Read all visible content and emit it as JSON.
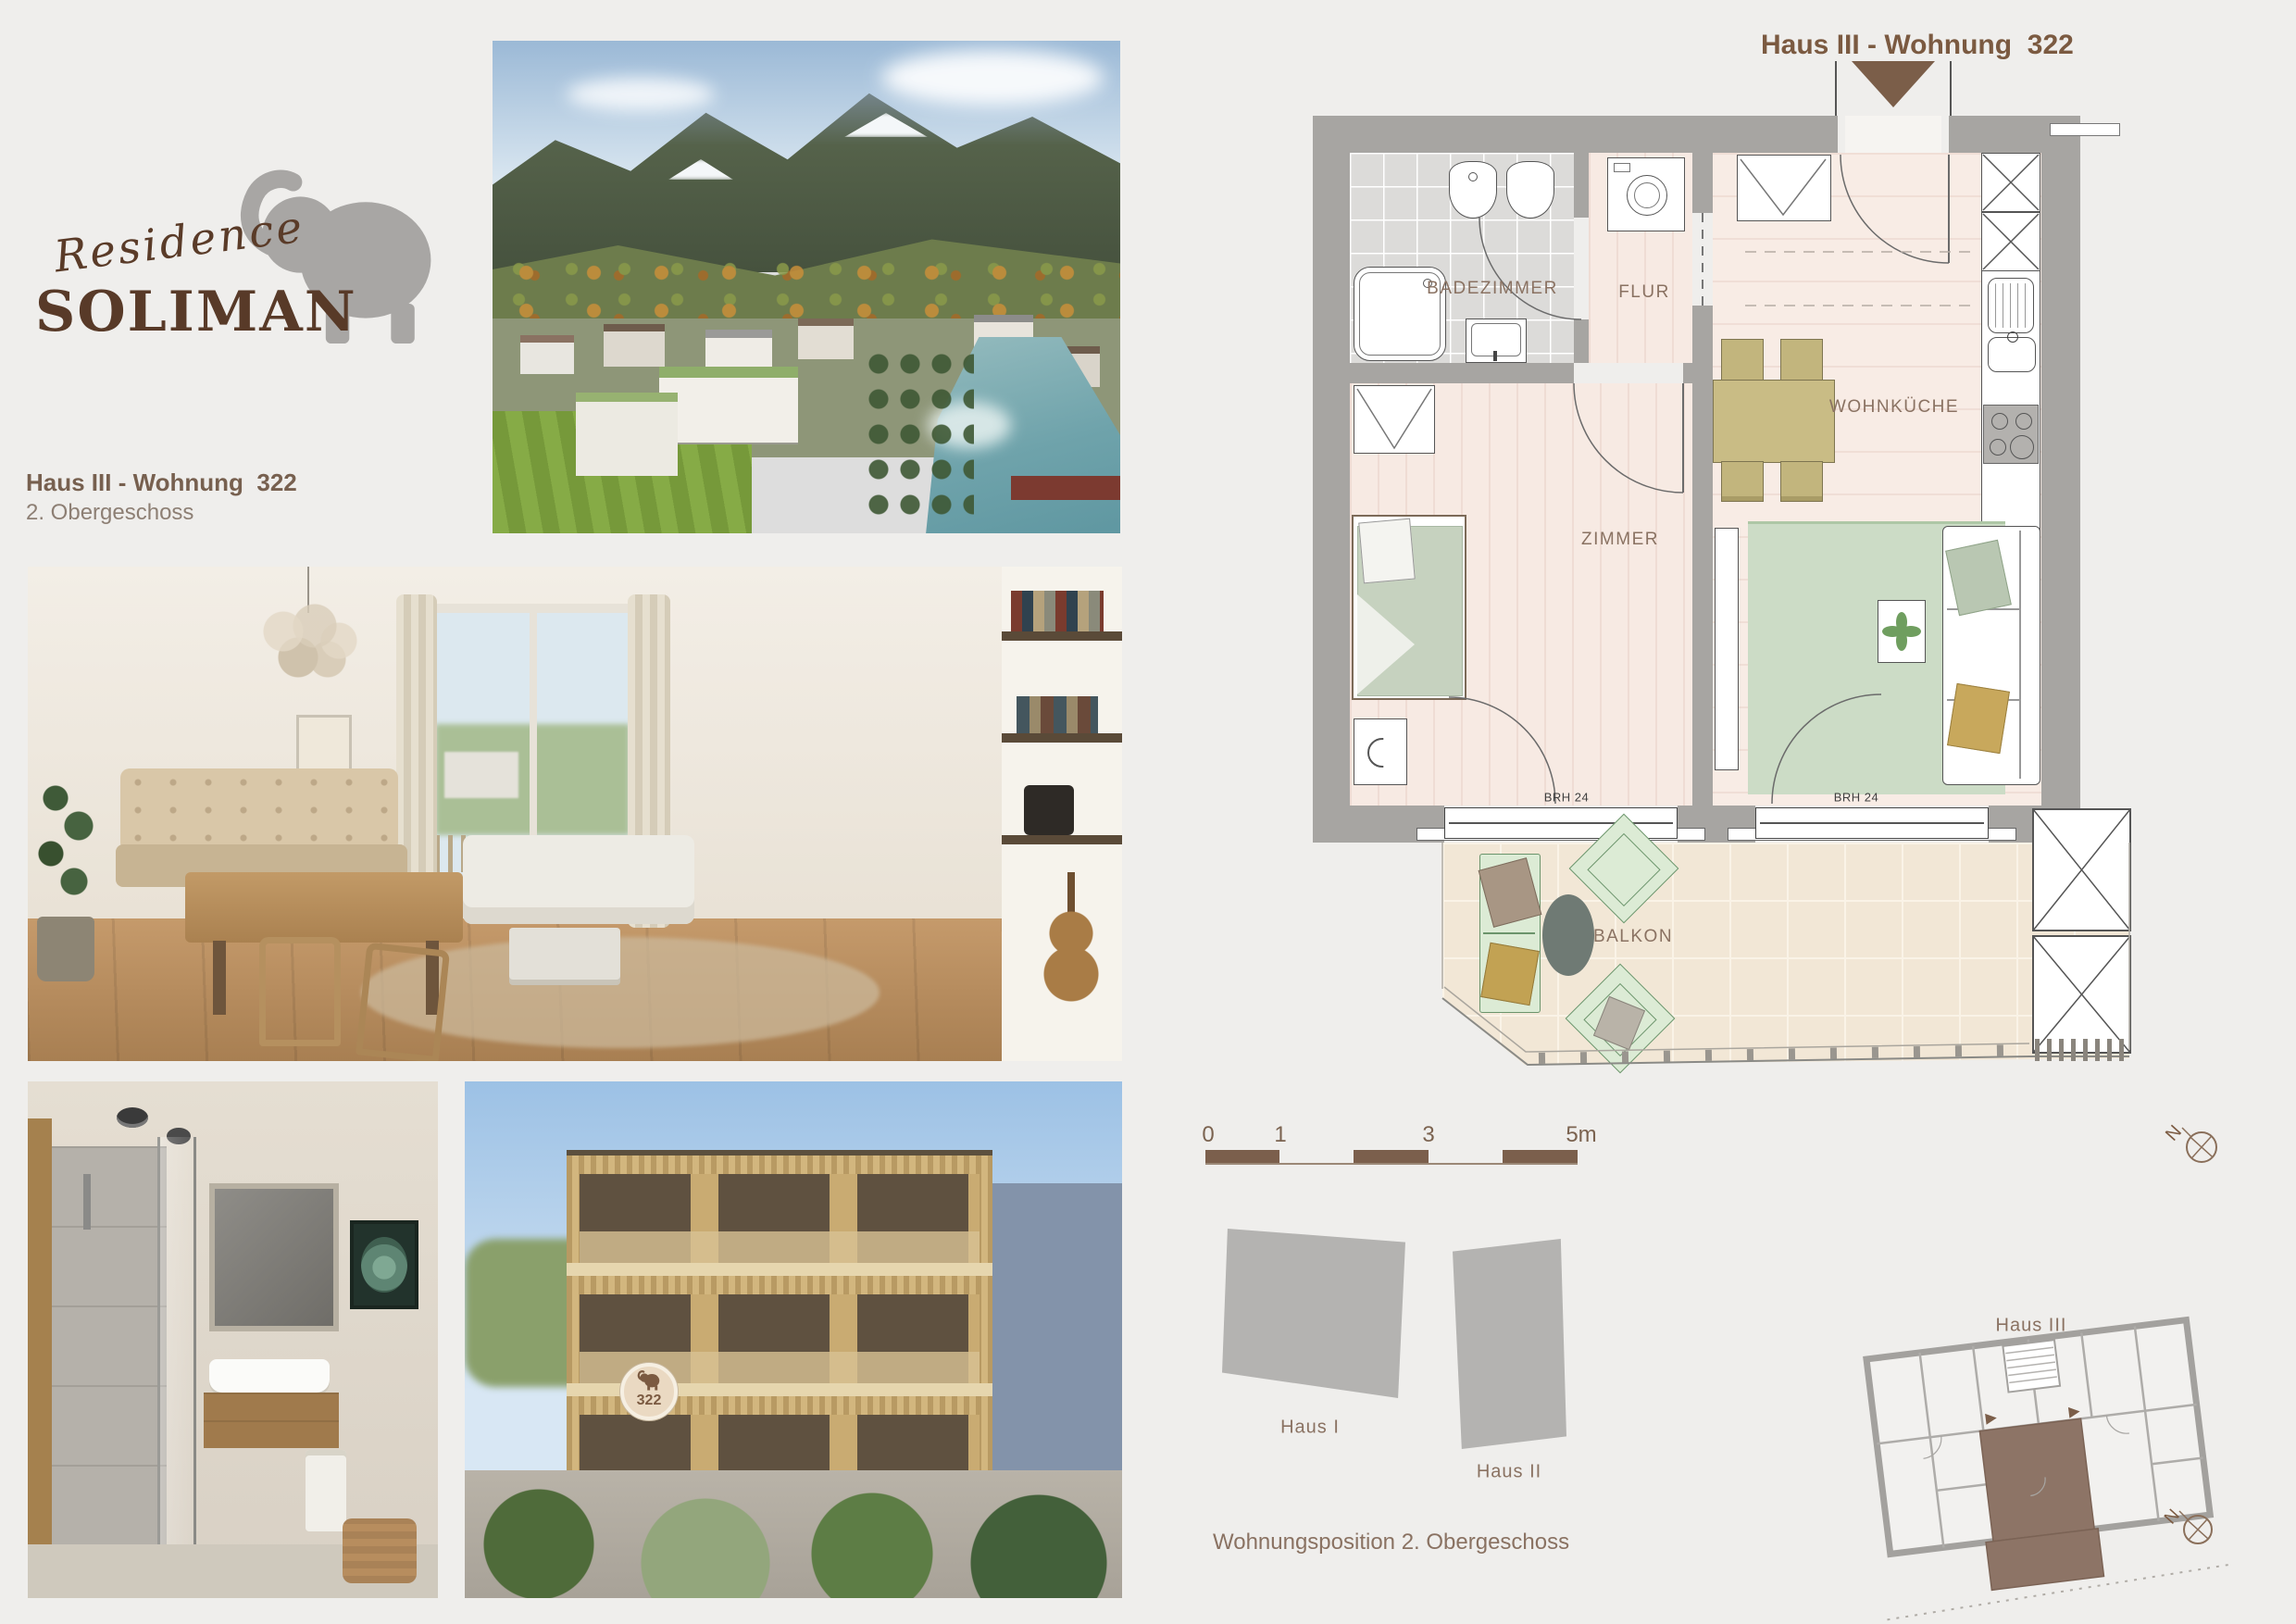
{
  "page": {
    "bg": "#efeeec"
  },
  "logo": {
    "script": "Residence",
    "name": "SOLIMAN"
  },
  "listing": {
    "title": "Haus III - Wohnung  322",
    "subtitle": "2. Obergeschoss"
  },
  "plan": {
    "title": "Haus III - Wohnung  322",
    "rooms": {
      "bathroom": "BADEZIMMER",
      "hall": "FLUR",
      "kitchen": "WOHNKÜCHE",
      "bedroom": "ZIMMER",
      "balcony": "BALKON"
    },
    "windows": {
      "left": "BRH 24",
      "right": "BRH 24"
    },
    "scale": {
      "t0": "0",
      "t1": "1",
      "t3": "3",
      "t5": "5m"
    },
    "compass": "N"
  },
  "site": {
    "haus1": "Haus I",
    "haus2": "Haus II",
    "haus3": "Haus III",
    "caption": "Wohnungsposition 2. Obergeschoss",
    "compass": "N",
    "badge": "322"
  },
  "colors": {
    "accent": "#7b5a41",
    "wall": "#a7a5a2",
    "floor_pink": "#f7eae3",
    "floor_tile": "#dcdbd9",
    "balcony_floor": "#f2e7d6",
    "site_gray": "#b4b3b1",
    "unit_brown": "#8d7466",
    "logo_brown": "#583a28"
  }
}
